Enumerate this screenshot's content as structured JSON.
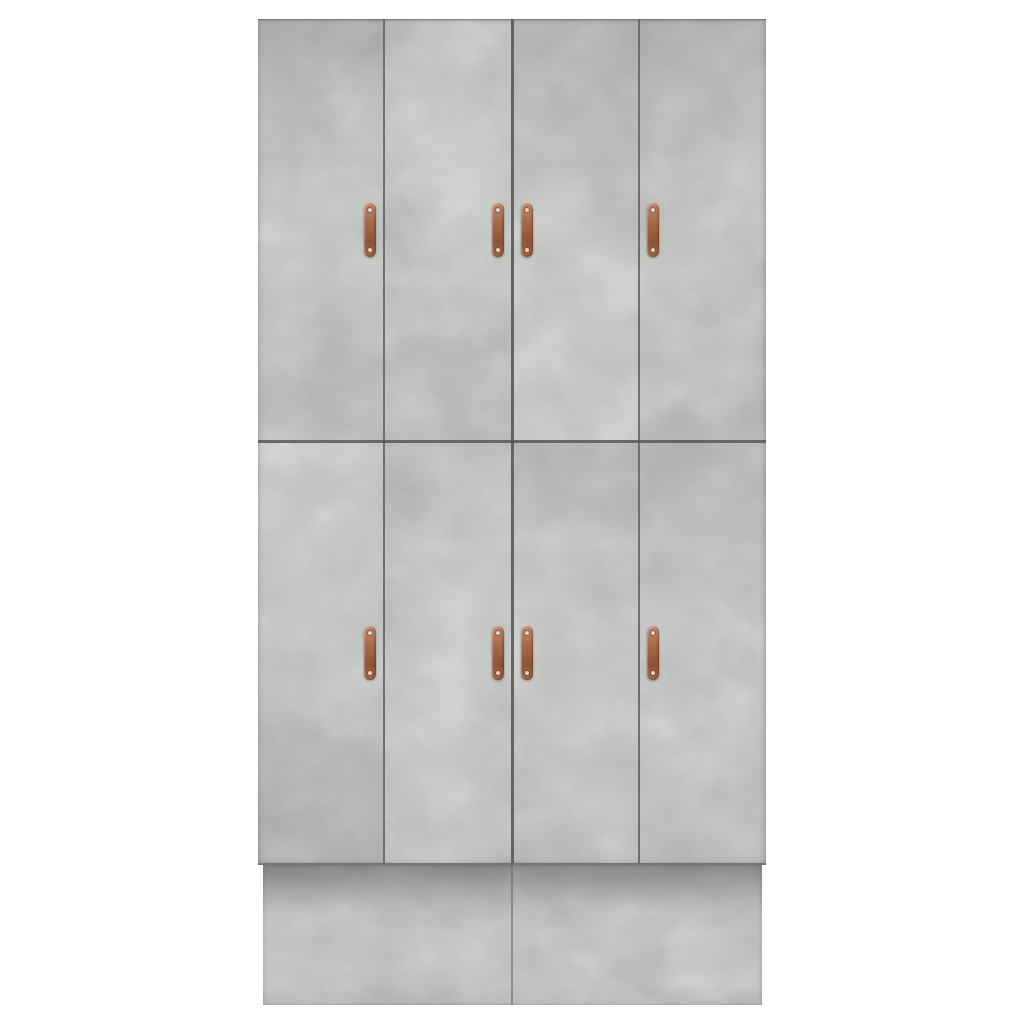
{
  "scene": {
    "type": "product-photo",
    "description": "Studio product photograph, straight-on front view of a tall rectangular wardrobe in a concrete-grey woodgrain finish standing on a recessed plinth base, against a plain white background. No text appears in the image.",
    "background_color": "#ffffff"
  },
  "wardrobe": {
    "finish": "concrete grey",
    "door_rows": 2,
    "door_columns": 4,
    "door_count": 8,
    "colors": {
      "panel_base": "#c6c8c5",
      "blotch_dark": "#9fa19e",
      "blotch_light": "#e6e8e5",
      "grain": "#8d8f8c",
      "seam": "#4e504d",
      "plinth_base": "#c9cbc8",
      "plinth_shadow": "#5f615e"
    },
    "doors": [
      {
        "row": 1,
        "col": 1,
        "name": "top-far-left-door",
        "handle_side": "right"
      },
      {
        "row": 1,
        "col": 2,
        "name": "top-mid-left-door",
        "handle_side": "right"
      },
      {
        "row": 1,
        "col": 3,
        "name": "top-mid-right-door",
        "handle_side": "left"
      },
      {
        "row": 1,
        "col": 4,
        "name": "top-far-right-door",
        "handle_side": "left"
      },
      {
        "row": 2,
        "col": 1,
        "name": "bottom-far-left-door",
        "handle_side": "right"
      },
      {
        "row": 2,
        "col": 2,
        "name": "bottom-mid-left-door",
        "handle_side": "right"
      },
      {
        "row": 2,
        "col": 3,
        "name": "bottom-mid-right-door",
        "handle_side": "left"
      },
      {
        "row": 2,
        "col": 4,
        "name": "bottom-far-right-door",
        "handle_side": "left"
      }
    ],
    "handle": {
      "count": 8,
      "style": "vertical copper strap pull with a screw at each end",
      "colors": {
        "light": "#c08a6d",
        "mid": "#a66a4b",
        "dark": "#8f5438",
        "screw": "#e3d2c5"
      }
    },
    "plinth": {
      "description": "recessed plinth base with a centre seam, shaded by the overhang of the doors above"
    }
  }
}
